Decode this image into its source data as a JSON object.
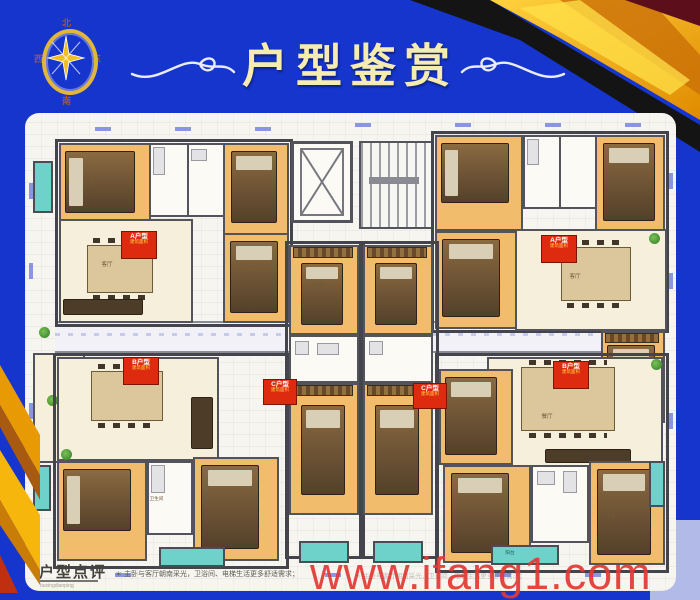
{
  "poster": {
    "title": "户型鉴赏",
    "bg_color": "#1635cd",
    "gold_color": "#f2a60a",
    "compass": {
      "n": "北",
      "s": "南",
      "e": "东",
      "w": "西"
    }
  },
  "floorplan": {
    "room_labels": {
      "master": "主卧",
      "bedroom": "卧室",
      "living": "客厅",
      "dining": "餐厅",
      "bath": "卫生间",
      "balcony": "阳台"
    },
    "badges": [
      {
        "t": "A户型",
        "a": "建筑面积"
      },
      {
        "t": "A户型",
        "a": "建筑面积"
      },
      {
        "t": "B户型",
        "a": "建筑面积"
      },
      {
        "t": "C户型",
        "a": "建筑面积"
      },
      {
        "t": "C户型",
        "a": "建筑面积"
      },
      {
        "t": "B户型",
        "a": "建筑面积"
      }
    ]
  },
  "footer": {
    "review_title": "户型点评",
    "review_pinyin": "huxingdianping",
    "review_text": "＊ 主卧与客厅朝南采光，卫浴间、电梯生活更多舒适需求；",
    "watermark": "www.ifang1.com",
    "watermark_color": "#e13a35"
  }
}
